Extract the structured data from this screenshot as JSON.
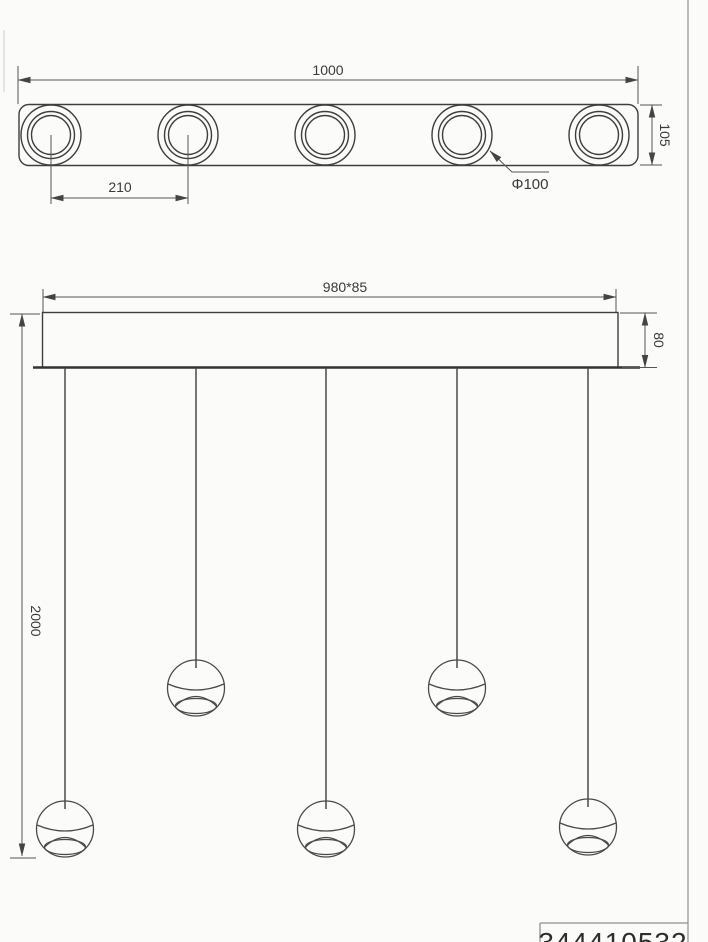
{
  "top_view": {
    "overall_width": "1000",
    "bar_height": "105",
    "lamp_spacing": "210",
    "lamp_diameter": "Φ100"
  },
  "front_view": {
    "canopy_size": "980*85",
    "canopy_height": "80",
    "suspension_drop": "2000"
  },
  "title_block": {
    "part_number": "344410532"
  },
  "colors": {
    "line": "#3e3e3e",
    "dimension": "#555555",
    "page_border": "#a8a8a8",
    "background": "#fbfbfa"
  }
}
